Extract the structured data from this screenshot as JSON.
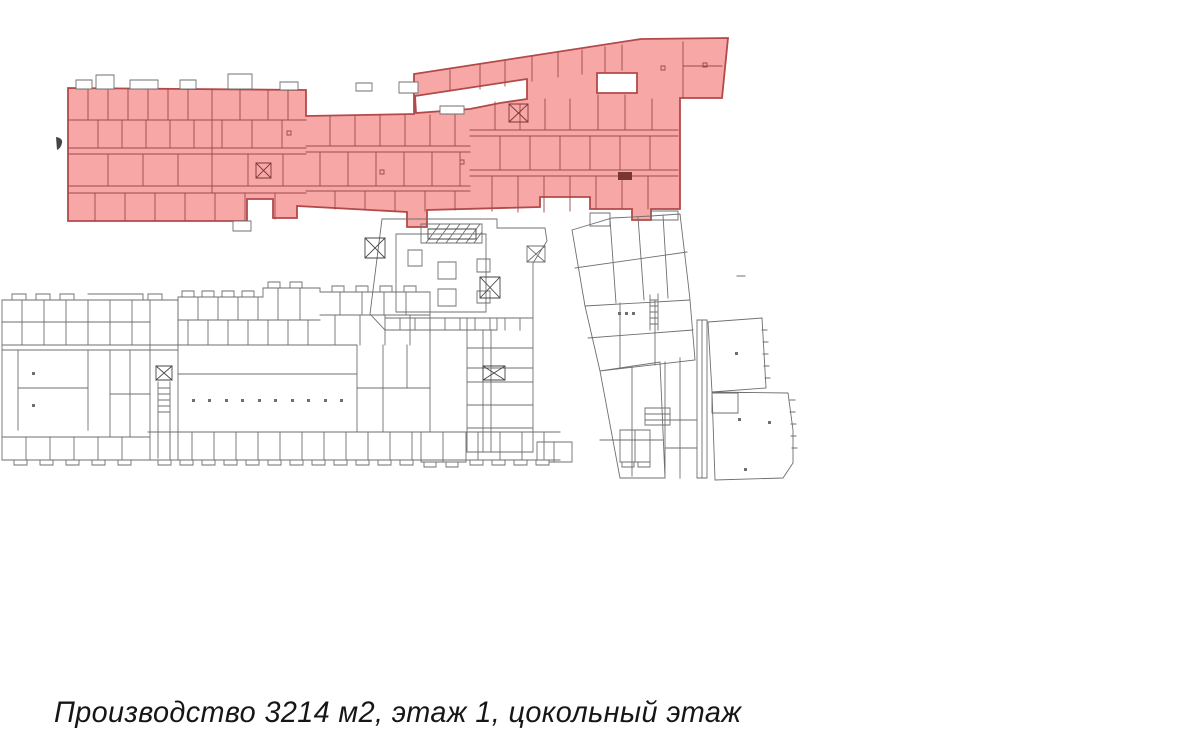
{
  "caption": {
    "text": "Производство 3214 м2, этаж 1, цокольный этаж"
  },
  "highlight": {
    "label": "Производство",
    "area": "3214 м2",
    "floor": "этаж 1",
    "level": "цокольный этаж"
  },
  "colors": {
    "background": "#ffffff",
    "highlight_fill": "#f8a7a7",
    "highlight_outline": "#b24a4a",
    "highlight_wall": "#9c4848",
    "highlight_wall_dark": "#7c3535",
    "plan_line": "#6f6f6f",
    "plan_line_dark": "#454545",
    "tab_fill": "#ffffff",
    "caption_color": "#161616"
  }
}
